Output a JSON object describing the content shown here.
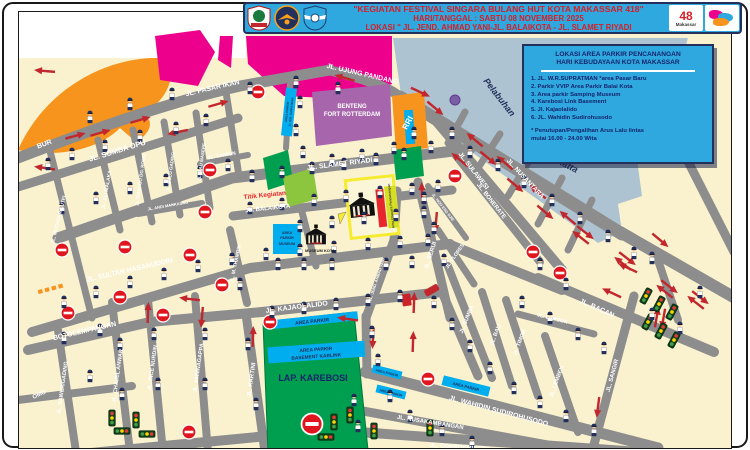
{
  "header": {
    "line1": "\"KEGIATAN FESTIVAL SINGARA BULANG HUT KOTA MAKASSAR 418\"",
    "line2": "HARI/TANGGAL : SABTU 08 NOVEMBER 2025",
    "line3": "LOKASI \" JL. JEND. AHMAD YANI-JL. BALAIKOTA - JL. SLAMET RIYADI",
    "bg_color": "#2FA8E0",
    "text_color": "#D61F26",
    "logo_48_number": "48",
    "logo_48_text": "Makassar",
    "logos": [
      "makassar-city-emblem",
      "dishub-logo",
      "police-traffic-logo",
      "makassar-418-logo",
      "singara-bulang-logo"
    ]
  },
  "info_box": {
    "bg_color": "#2FA8E0",
    "title1": "LOKASI AREA PARKIR PENCANANGAN",
    "title2": "HARI KEBUDAYAAN KOTA MAKASSAR",
    "items": [
      "1.  JL. W.R.SUPRATMAN *area Pasar Baru",
      "2.  Parkir VVIP Area Parkir Balai Kota",
      "3.  Area parkir Samping Museum",
      "4.  Karebosi Link Basement",
      "5.  Jl. Kajaolalido",
      "6.  JL. Wahidin Sudirohusodo"
    ],
    "note1": "* Penutupan/Pengalihan Arus Lalu lintas",
    "note2": "mulai 16.00 - 24.00 Wita"
  },
  "map": {
    "landmarks": {
      "fort_line1": "BENTENG",
      "fort_line2": "FORT ROTTERDAM",
      "rri": "RRI",
      "karebosi": "LAP. KAREBOSI",
      "museum": "MUSEUM KOTA",
      "harbor_word1": "Pelabuhan",
      "harbor_word2": "Hatta",
      "event_point": "Titik Kegiatan",
      "ceremony_area": "Area Upacara Pencanangan"
    },
    "parking": {
      "generic": "AREA PARKIR",
      "basement": "BASEMENT KARLINK",
      "supratman": "JL. W.R. SUPRATMAN",
      "area_word": "AREA",
      "parkir_word": "PARKIR",
      "museum_word": "MUSEUM"
    },
    "streets": [
      "JL. PASAR IKAN",
      "JL. UJUNG PANDANG",
      "JL. SOMBA OPU",
      "BUR",
      "JL. MUCHTAR LUTFI",
      "JL. ALI MALAKA",
      "JL. RANGGO DG. ROMO",
      "JL. BULO GADING",
      "JL. BAU MASEPE",
      "JL. SAMIUN",
      "JL. ANDI MAKKASAU",
      "JL. SLAMET RIYADI",
      "JL. NUSANTARA",
      "JL. SULAWESI",
      "JL. BONERATE",
      "JL. HOO ENG DJIE",
      "JL. SULTAN HASANUDDIN",
      "BOTOLEMPANGAN",
      "JL. KAJAOLALIDO",
      "JL. SAWERIGADING",
      "JL. CHAIRIL ANWAR",
      "JL. INCE NURDIN",
      "JL. AMMNAGAPPA",
      "JL. KARTINI",
      "JL. M. THAMRIN",
      "JL. JEND. AHMAD YANI",
      "JL. SERUI",
      "JL. FLORES",
      "JL. SUMBA",
      "JL. BALI",
      "JL. TIMOR",
      "JL. LOMBOK",
      "JL. BACAN",
      "JL. LEMBEH",
      "JL. SANGIR",
      "JL. WAHIDIN SUDIROHUSODO",
      "JL. NUSAKAMBANGAN",
      "JL. COKROAMINOTO",
      "JL. BALAIKOTA",
      "OMO"
    ],
    "icons": {
      "police": "police-officer-icon",
      "no_entry": "no-entry-sign-icon",
      "traffic_light": "traffic-light-icon",
      "arrow": "flow-arrow-icon",
      "double_arrow": "two-way-arrow-icon",
      "building": "government-building-icon"
    }
  },
  "colors": {
    "street": "#8D8D8D",
    "land": "#FAF2CF",
    "harbor": "#ADC3D1",
    "coast_orange": "#F7941D",
    "building_magenta": "#EC008C",
    "fort_purple": "#A765AC",
    "field_green": "#009E4F",
    "parking_blue": "#00AEEF",
    "flow_red": "#C1272D",
    "accent_yellow": "#F5EB2F",
    "ceremony_lime": "#D7DF23"
  }
}
